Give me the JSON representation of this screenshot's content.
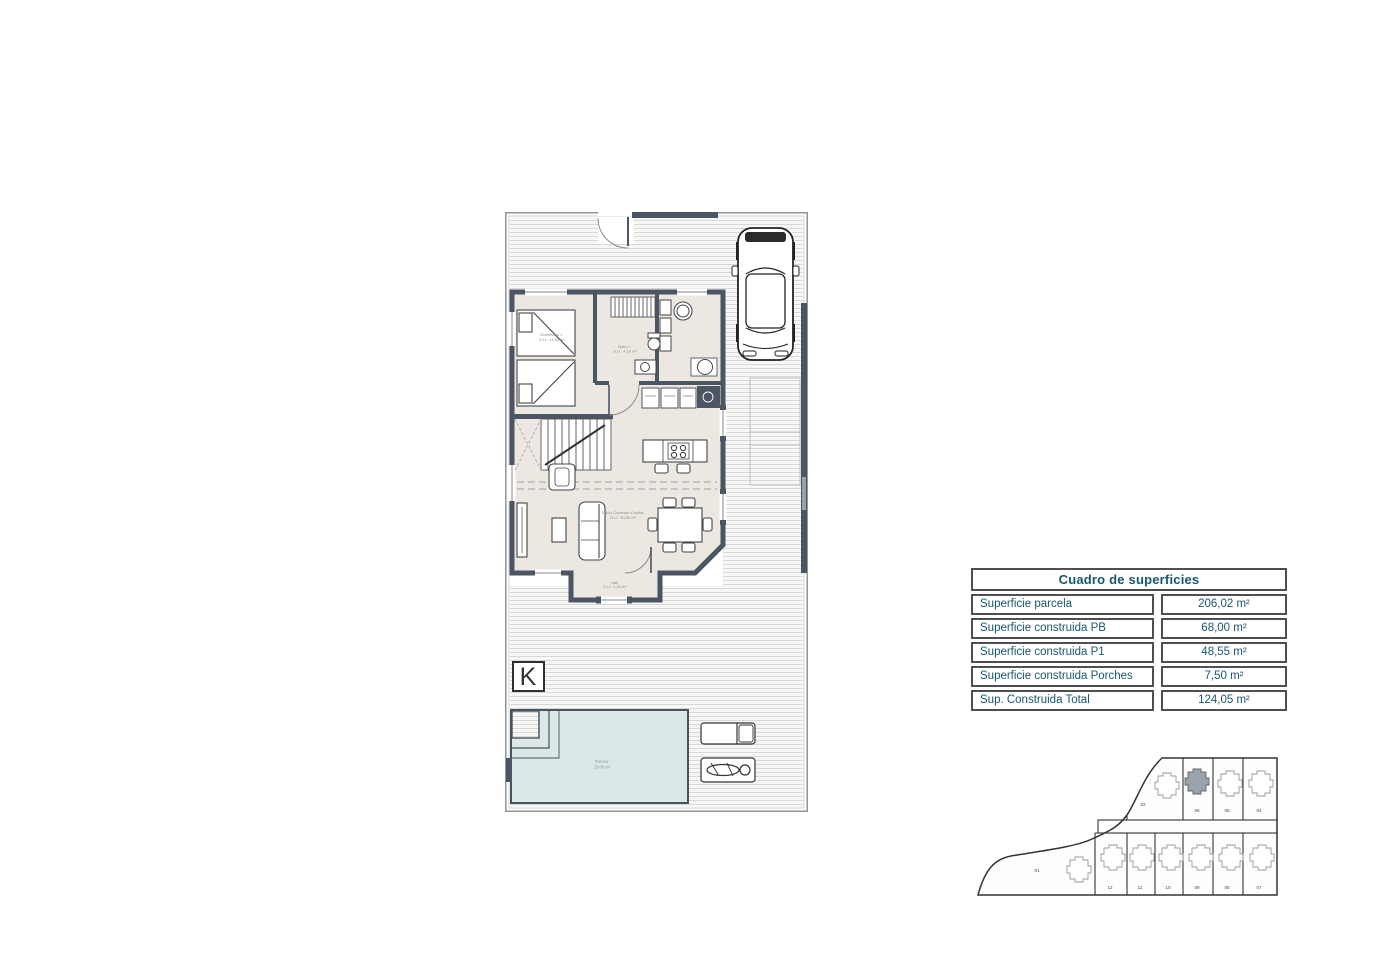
{
  "page": {
    "background": "#ffffff"
  },
  "floor_plan": {
    "colors": {
      "wall": "#4b5563",
      "floor": "#ece7e1",
      "pool_fill": "#dce8e8",
      "stripe": "#d8d8d8"
    },
    "labels": {
      "bedroom_name": "Dormitorio 1",
      "bedroom_area": "S.U.: 11,90 m²",
      "bath_name": "Baño 1",
      "bath_area": "S.U.: 4,10 m²",
      "living_name": "Salón-Comedor-Cocina",
      "living_area": "S.U.: 30,00 m²",
      "hall_name": "Hall",
      "hall_area": "S.U.: 1,20 m²",
      "pool_name": "Piscina",
      "pool_area": "18,00 m²",
      "logo": "K"
    }
  },
  "surface_table": {
    "title": "Cuadro de superficies",
    "text_color": "#19576e",
    "rows": [
      {
        "label": "Superficie parcela",
        "value": "206,02 m²"
      },
      {
        "label": "Superficie construida PB",
        "value": "68,00 m²"
      },
      {
        "label": "Superficie construida P1",
        "value": "48,55 m²"
      },
      {
        "label": "Superficie construida Porches",
        "value": "7,50 m²"
      },
      {
        "label": "Sup. Construida Total",
        "value": "124,05 m²"
      }
    ]
  },
  "site_plan": {
    "highlight_color": "#9aa2ab",
    "plot_large": "01",
    "plots_top": [
      "02",
      "06",
      "05",
      "04"
    ],
    "plots_bottom": [
      "12",
      "11",
      "10",
      "09",
      "08",
      "07"
    ]
  }
}
